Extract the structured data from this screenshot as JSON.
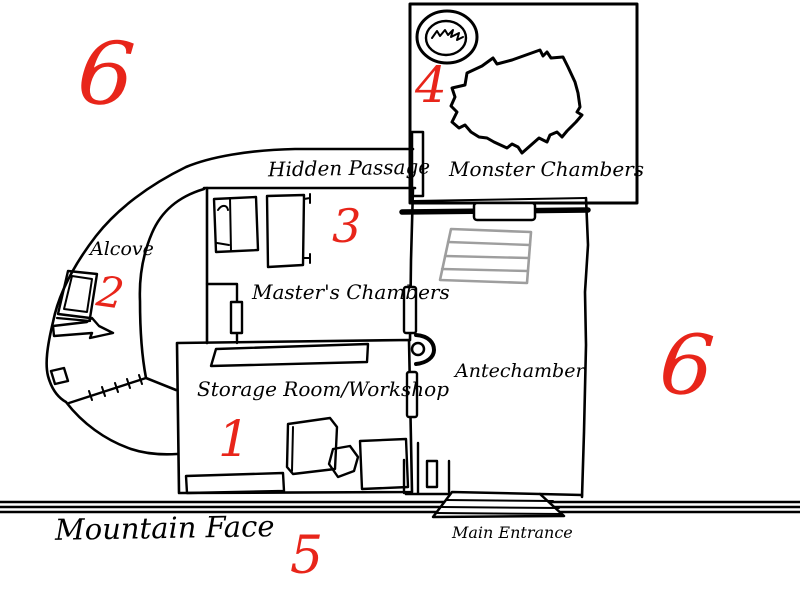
{
  "colors": {
    "ink": "#000000",
    "marker_red": "#e8251a",
    "stairs_gray": "#9e9e9e",
    "paper": "#ffffff"
  },
  "labels": {
    "hidden_passage": "Hidden Passage",
    "monster_chambers": "Monster Chambers",
    "masters_chambers": "Master's Chambers",
    "alcove": "Alcove",
    "storage_room": "Storage Room/Workshop",
    "antechamber": "Antechamber",
    "mountain_face": "Mountain Face",
    "main_entrance": "Main Entrance"
  },
  "markers": {
    "storage": "1",
    "alcove": "2",
    "masters": "3",
    "monster": "4",
    "entrance": "5",
    "outside_top_left": "6",
    "outside_right": "6"
  }
}
